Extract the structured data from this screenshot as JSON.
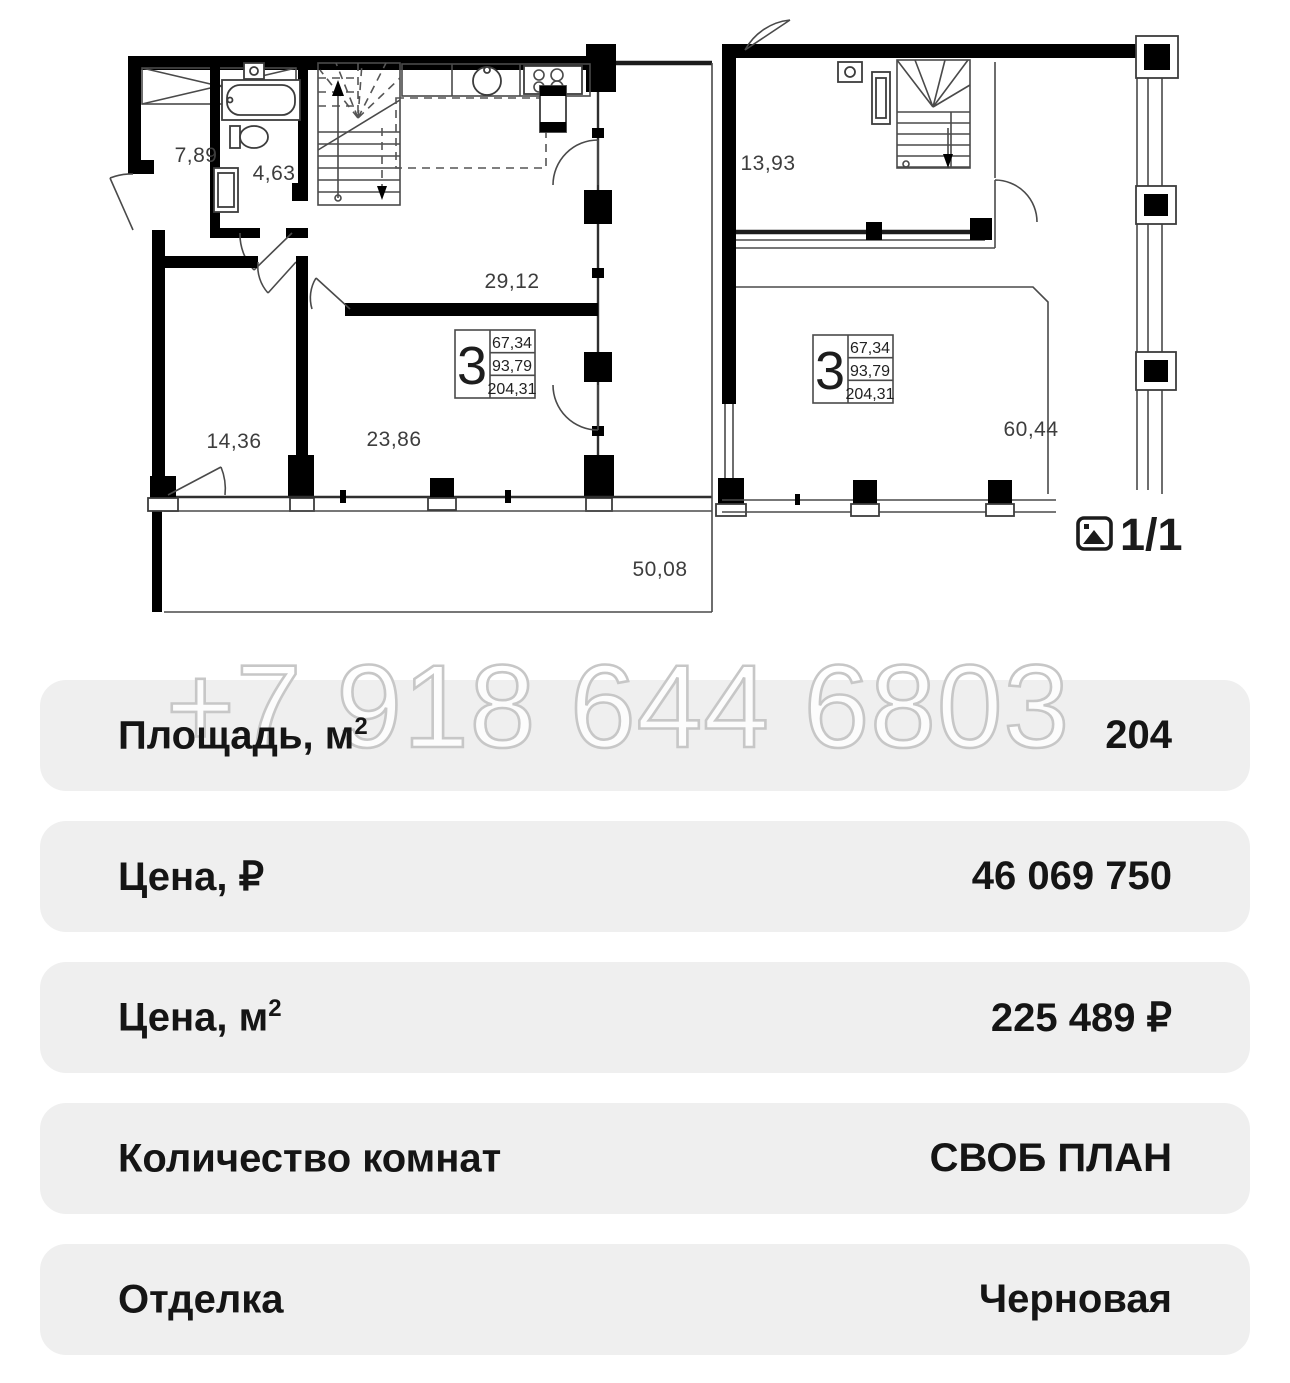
{
  "plans": {
    "left": {
      "room_labels": [
        "7,89",
        "4,63",
        "29,12",
        "14,36",
        "23,86",
        "50,08"
      ],
      "badge": {
        "number": "3",
        "value1": "67,34",
        "value2": "93,79",
        "value3": "204,31"
      }
    },
    "right": {
      "room_labels": [
        "13,93",
        "60,44"
      ],
      "badge": {
        "number": "3",
        "value1": "67,34",
        "value2": "93,79",
        "value3": "204,31"
      }
    }
  },
  "gallery": {
    "counter": "1/1",
    "icon": "image-icon"
  },
  "watermark": {
    "text": "+7 918 644 6803"
  },
  "details": {
    "rows": [
      {
        "label_base": "Площадь, м",
        "label_sup": "2",
        "value": "204"
      },
      {
        "label_base": "Цена, ₽",
        "label_sup": "",
        "value": "46 069 750"
      },
      {
        "label_base": "Цена, м",
        "label_sup": "2",
        "value": "225 489 ₽"
      },
      {
        "label_base": "Количество комнат",
        "label_sup": "",
        "value": "СВОБ ПЛАН"
      },
      {
        "label_base": "Отделка",
        "label_sup": "",
        "value": "Черновая"
      }
    ]
  },
  "colors": {
    "row_bg": "#efefef",
    "text": "#151515",
    "plan_walls": "#000000",
    "watermark_stroke": "#c7c7c7"
  }
}
